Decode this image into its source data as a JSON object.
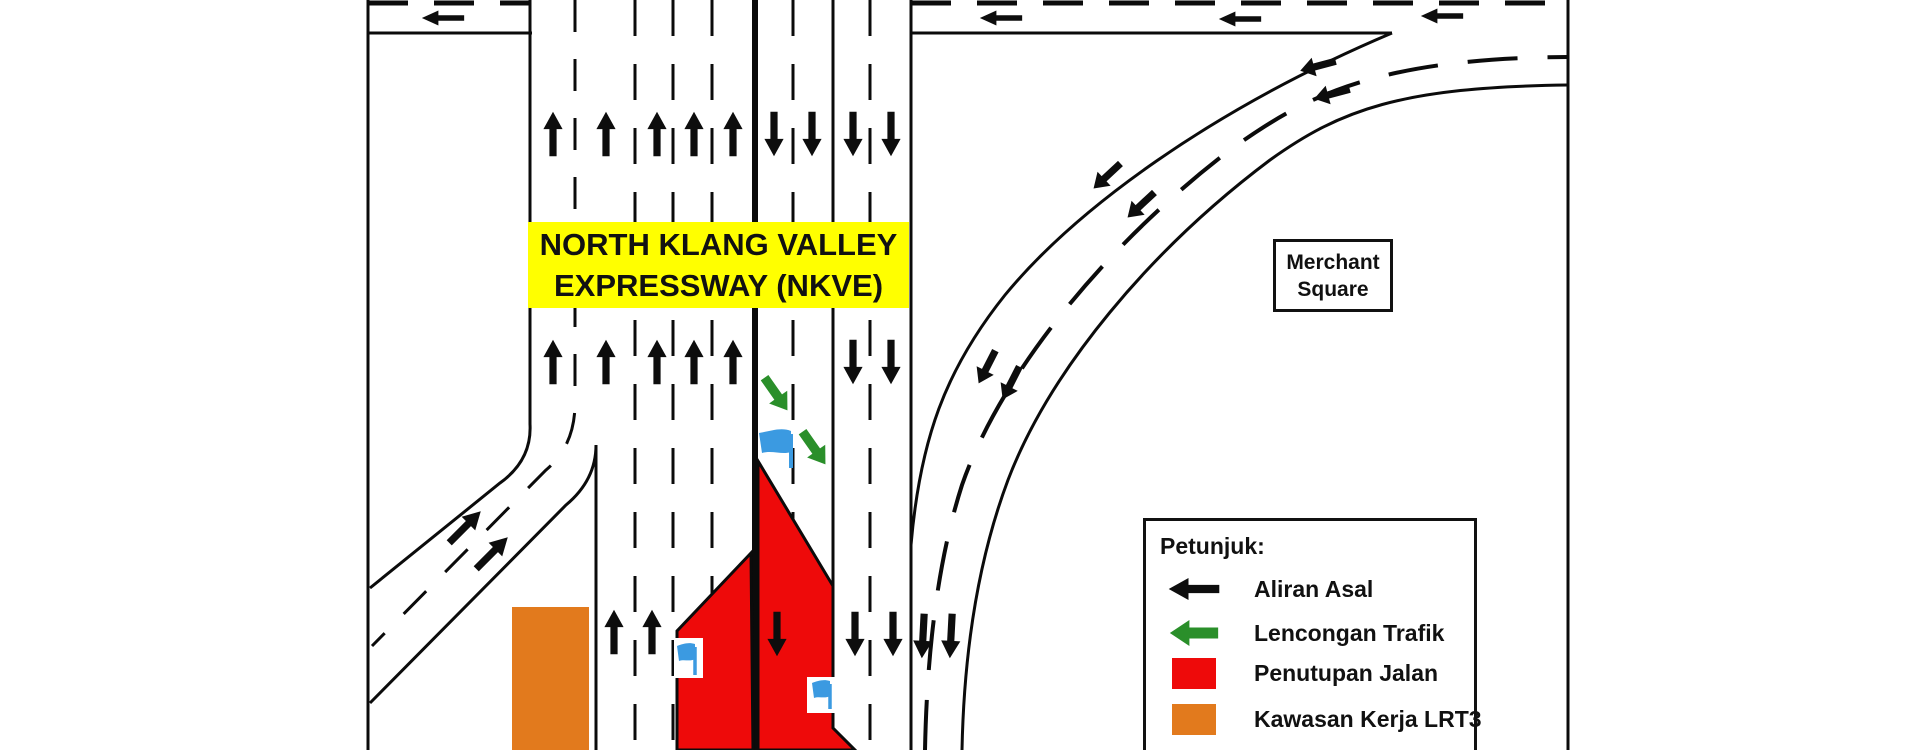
{
  "banner": {
    "line1": "NORTH KLANG VALLEY",
    "line2": "EXPRESSWAY (NKVE)"
  },
  "landmark": {
    "line1": "Merchant",
    "line2": "Square"
  },
  "legend": {
    "title": "Petunjuk:",
    "items": [
      {
        "icon": "black-left-arrow",
        "label": "Aliran Asal"
      },
      {
        "icon": "green-left-arrow",
        "label": "Lencongan Trafik"
      },
      {
        "icon": "red-swatch",
        "label": "Penutupan Jalan"
      },
      {
        "icon": "orange-swatch",
        "label": "Kawasan Kerja LRT3"
      }
    ]
  },
  "colors": {
    "flow_black": "#0d0d0d",
    "road_line": "#0b0b0b",
    "closure_red": "#ee0a0a",
    "work_orange": "#e27a1d",
    "diversion_green": "#2a8f2a",
    "banner_yellow": "#ffff00",
    "flag_blue": "#3b9ae1"
  }
}
